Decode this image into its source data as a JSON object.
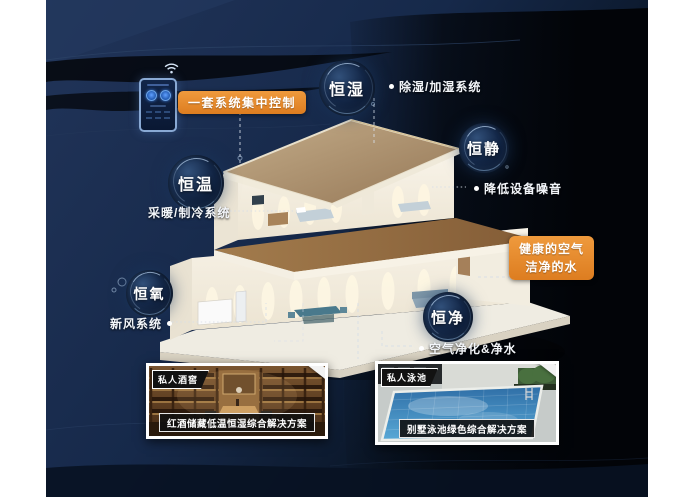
{
  "control": {
    "label": "一套系统集中控制"
  },
  "highlight": {
    "line1": "健康的空气",
    "line2": "洁净的水"
  },
  "features": [
    {
      "name": "humidity",
      "bubble": "恒湿",
      "note": "除湿/加湿系统"
    },
    {
      "name": "quiet",
      "bubble": "恒静",
      "note": "降低设备噪音"
    },
    {
      "name": "temperature",
      "bubble": "恒温",
      "note": "采暖/制冷系统"
    },
    {
      "name": "oxygen",
      "bubble": "恒氧",
      "note": "新风系统"
    },
    {
      "name": "purity",
      "bubble": "恒净",
      "note": "空气净化&净水"
    }
  ],
  "cards": [
    {
      "badge": "私人酒窖",
      "caption": "红酒储藏低温恒湿综合解决方案"
    },
    {
      "badge": "私人泳池",
      "caption": "别墅泳池绿色综合解决方案"
    }
  ],
  "colors": {
    "background_navy": "#1d3055",
    "wave_dark": "#04070d",
    "accent_orange": "#e5862e",
    "text": "#ffffff"
  }
}
